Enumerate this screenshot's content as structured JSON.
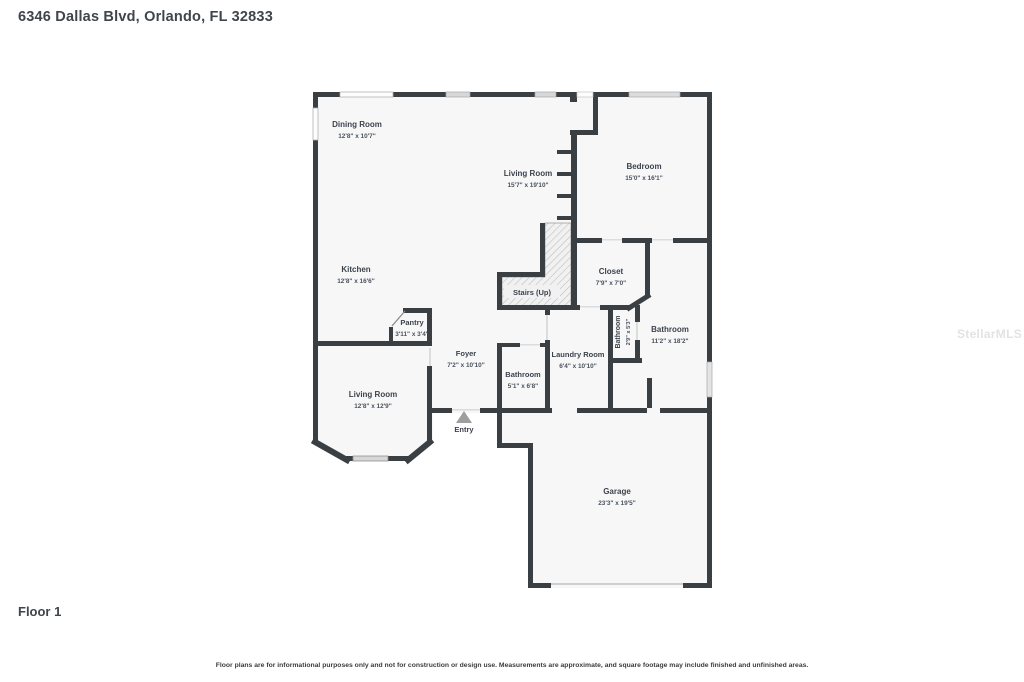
{
  "title": "6346 Dallas Blvd, Orlando, FL 32833",
  "floor_label": "Floor 1",
  "watermark": "StellarMLS",
  "disclaimer": "Floor plans are for informational purposes only and not for construction or design use. Measurements are approximate, and square footage may include finished and unfinished areas.",
  "rooms": {
    "dining": {
      "name": "Dining Room",
      "dims": "12'8\" x 10'7\""
    },
    "living_top": {
      "name": "Living Room",
      "dims": "15'7\" x 19'10\""
    },
    "bedroom": {
      "name": "Bedroom",
      "dims": "15'0\" x 16'1\""
    },
    "kitchen": {
      "name": "Kitchen",
      "dims": "12'8\" x 16'6\""
    },
    "closet": {
      "name": "Closet",
      "dims": "7'9\" x 7'0\""
    },
    "stairs": {
      "name": "Stairs (Up)"
    },
    "pantry": {
      "name": "Pantry",
      "dims": "3'11\" x 3'4\""
    },
    "bath_vertical": {
      "name": "Bathroom",
      "dims": "2'9\" x 5'3\""
    },
    "bath_main": {
      "name": "Bathroom",
      "dims": "11'2\" x 18'2\""
    },
    "foyer": {
      "name": "Foyer",
      "dims": "7'2\" x 10'10\""
    },
    "laundry": {
      "name": "Laundry Room",
      "dims": "6'4\" x 10'10\""
    },
    "bath_hall": {
      "name": "Bathroom",
      "dims": "5'1\" x 6'8\""
    },
    "living_bottom": {
      "name": "Living Room",
      "dims": "12'8\" x 12'9\""
    },
    "entry": {
      "name": "Entry"
    },
    "garage": {
      "name": "Garage",
      "dims": "23'3\" x 19'5\""
    }
  },
  "colors": {
    "wall": "#3a3f43",
    "room_fill": "#f7f7f8",
    "window_fill": "#d7d7d7",
    "label_text": "#3c434c",
    "watermark_text": "#e3e3e5",
    "entry_arrow": "#9e9e9e"
  }
}
